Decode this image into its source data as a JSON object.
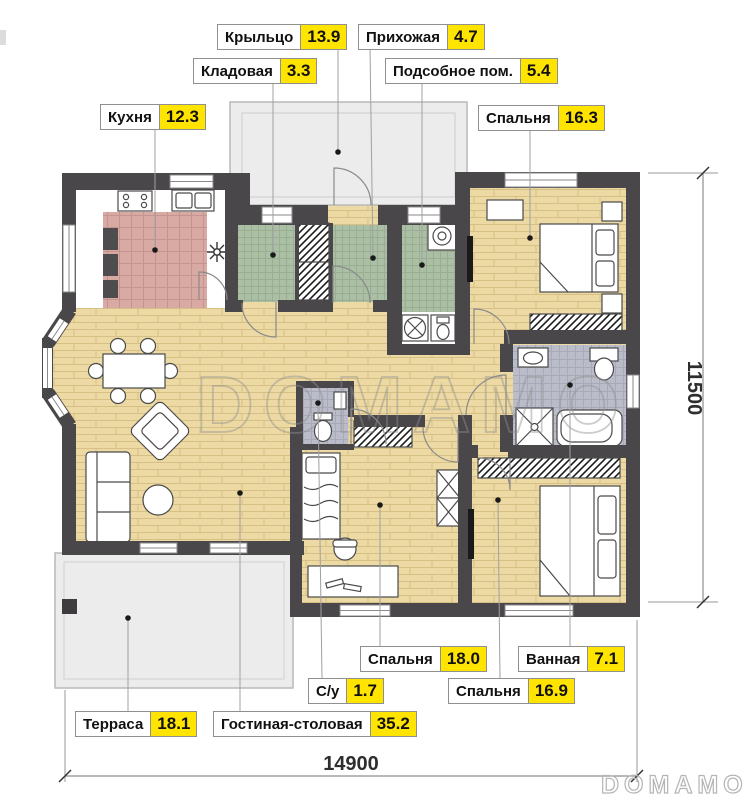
{
  "plan": {
    "watermark": "DOMAMO",
    "brand": "DOMAMO",
    "rooms": [
      {
        "name": "Крыльцо",
        "area": "13.9"
      },
      {
        "name": "Прихожая",
        "area": "4.7"
      },
      {
        "name": "Кладовая",
        "area": "3.3"
      },
      {
        "name": "Подсобное пом.",
        "area": "5.4"
      },
      {
        "name": "Кухня",
        "area": "12.3"
      },
      {
        "name": "Спальня",
        "area": "16.3"
      },
      {
        "name": "Спальня",
        "area": "18.0"
      },
      {
        "name": "Ванная",
        "area": "7.1"
      },
      {
        "name": "С/у",
        "area": "1.7"
      },
      {
        "name": "Спальня",
        "area": "16.9"
      },
      {
        "name": "Терраса",
        "area": "18.1"
      },
      {
        "name": "Гостиная-столовая",
        "area": "35.2"
      }
    ],
    "dimensions": {
      "width": "14900",
      "height": "11500"
    },
    "colors": {
      "wall": "#4a474b",
      "wood_floor": "#ecd9a3",
      "kitchen_tile": "#d9aaa3",
      "green_tile": "#abbfa5",
      "gray_tile": "#babcc9",
      "paved": "#ececec",
      "area_highlight": "#ffe400"
    }
  }
}
